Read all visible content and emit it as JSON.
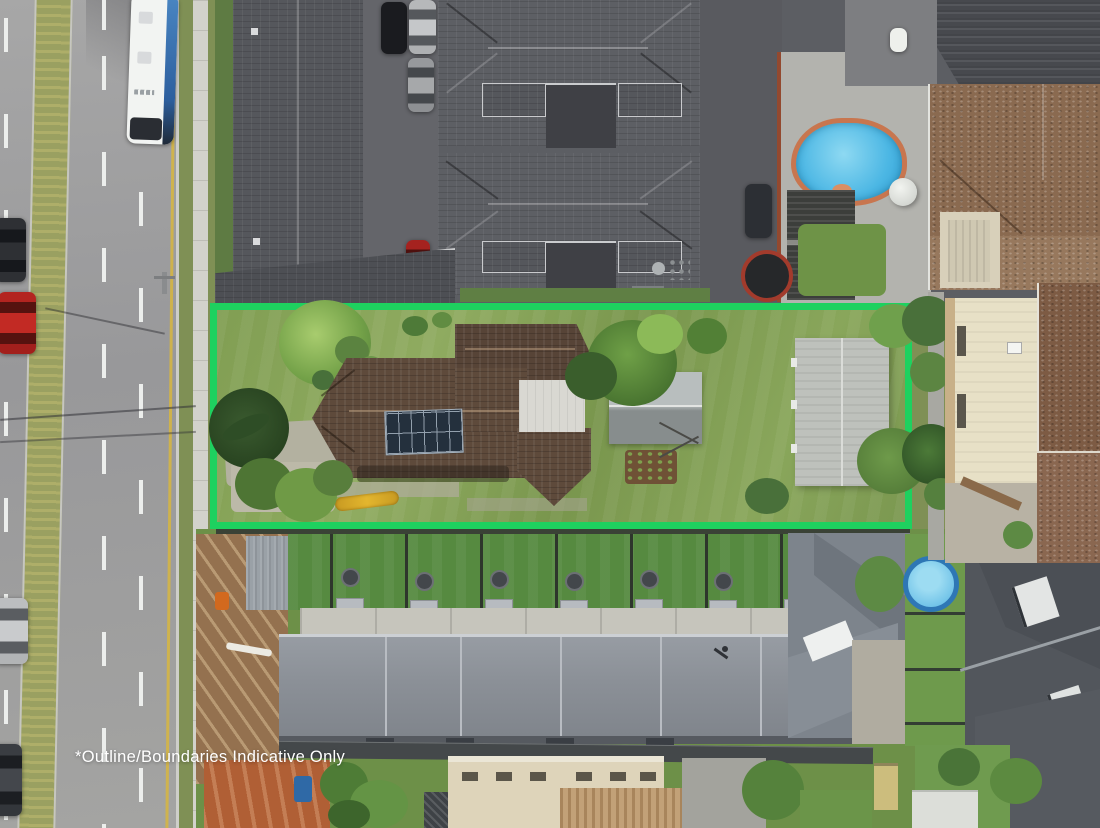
{
  "photo": {
    "type": "aerial-drone-photograph",
    "watermark_text": "*Outline/Boundaries Indicative Only",
    "boundary_outline_color": "#1ed15f",
    "palette": {
      "road_asphalt": "#9d9d9d",
      "median_grass": "#9aa061",
      "kerb_yellow_line": "#d4b545",
      "lawn_green": "#819e53",
      "dark_tile_roof": "#55575c",
      "brown_tile_roof": "#5e4a3b",
      "tan_brick_roof": "#8a6a50",
      "metal_roof_gray": "#8b9097",
      "pool_water": "#4cb7e4",
      "pool_coping": "#c8764f",
      "solar_panel": "#24303d",
      "construction_dirt": "#94714f",
      "orange_dirt": "#b05f35",
      "kayak_yellow": "#d8a527"
    },
    "features": [
      "highlighted-property-boundary",
      "main-house-brown-tile-roof",
      "solar-panel-array",
      "garden-shed",
      "large-shed",
      "front-driveway",
      "palm-tree",
      "yellow-kayak",
      "neighbour-swimming-pool",
      "trampoline",
      "water-tank",
      "bus-on-road",
      "parked-cars",
      "grass-median-strip",
      "townhouse-dark-roofs",
      "modern-townhouse-row",
      "backyard-ac-units",
      "construction-site",
      "kiddie-pool"
    ]
  }
}
